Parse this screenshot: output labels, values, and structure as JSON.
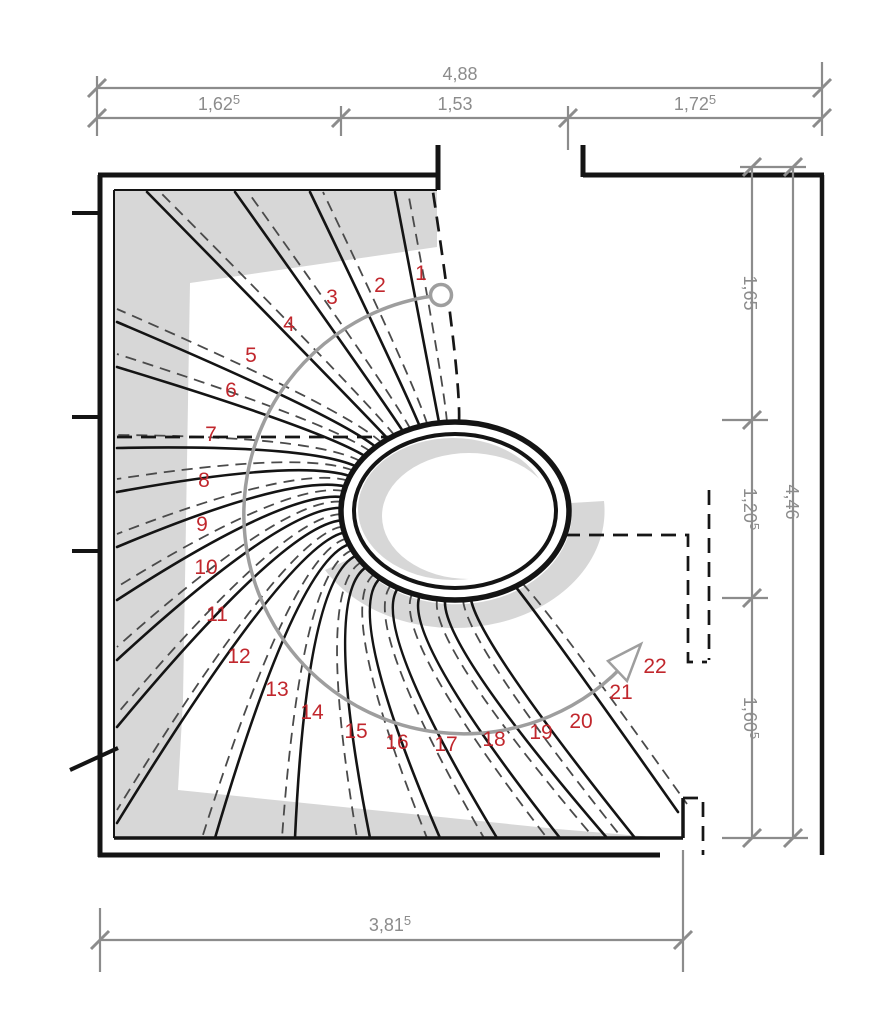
{
  "drawing": {
    "type": "stair-plan",
    "description": "Plan view of a curved winder staircase with elliptical well, 22 numbered treads and walking line"
  },
  "colors": {
    "step_number": "#c1272d",
    "dimension": "#8c8c8c",
    "walk_line": "#9e9e9e",
    "shading": "#d7d7d7",
    "line": "#141414"
  },
  "plan": {
    "steps": [
      {
        "n": "1",
        "x": 421,
        "y": 273
      },
      {
        "n": "2",
        "x": 380,
        "y": 285
      },
      {
        "n": "3",
        "x": 332,
        "y": 297
      },
      {
        "n": "4",
        "x": 289,
        "y": 324
      },
      {
        "n": "5",
        "x": 251,
        "y": 355
      },
      {
        "n": "6",
        "x": 231,
        "y": 390
      },
      {
        "n": "7",
        "x": 211,
        "y": 434
      },
      {
        "n": "8",
        "x": 204,
        "y": 480
      },
      {
        "n": "9",
        "x": 202,
        "y": 524
      },
      {
        "n": "10",
        "x": 206,
        "y": 567
      },
      {
        "n": "11",
        "x": 217,
        "y": 614
      },
      {
        "n": "12",
        "x": 239,
        "y": 656
      },
      {
        "n": "13",
        "x": 277,
        "y": 689
      },
      {
        "n": "14",
        "x": 312,
        "y": 712
      },
      {
        "n": "15",
        "x": 356,
        "y": 731
      },
      {
        "n": "16",
        "x": 397,
        "y": 742
      },
      {
        "n": "17",
        "x": 446,
        "y": 744
      },
      {
        "n": "18",
        "x": 494,
        "y": 739
      },
      {
        "n": "19",
        "x": 541,
        "y": 732
      },
      {
        "n": "20",
        "x": 581,
        "y": 721
      },
      {
        "n": "21",
        "x": 621,
        "y": 692
      },
      {
        "n": "22",
        "x": 655,
        "y": 666
      }
    ]
  },
  "dimensions": {
    "top_total": {
      "text": "4,88",
      "sup": ""
    },
    "top_segments": [
      {
        "text": "1,62",
        "sup": "5"
      },
      {
        "text": "1,53",
        "sup": ""
      },
      {
        "text": "1,72",
        "sup": "5"
      }
    ],
    "right_total": {
      "text": "4,46",
      "sup": ""
    },
    "right_segments": [
      {
        "text": "1,65",
        "sup": ""
      },
      {
        "text": "1,20",
        "sup": "5"
      },
      {
        "text": "1,60",
        "sup": "5"
      }
    ],
    "bottom_total": {
      "text": "3,81",
      "sup": "5"
    }
  }
}
